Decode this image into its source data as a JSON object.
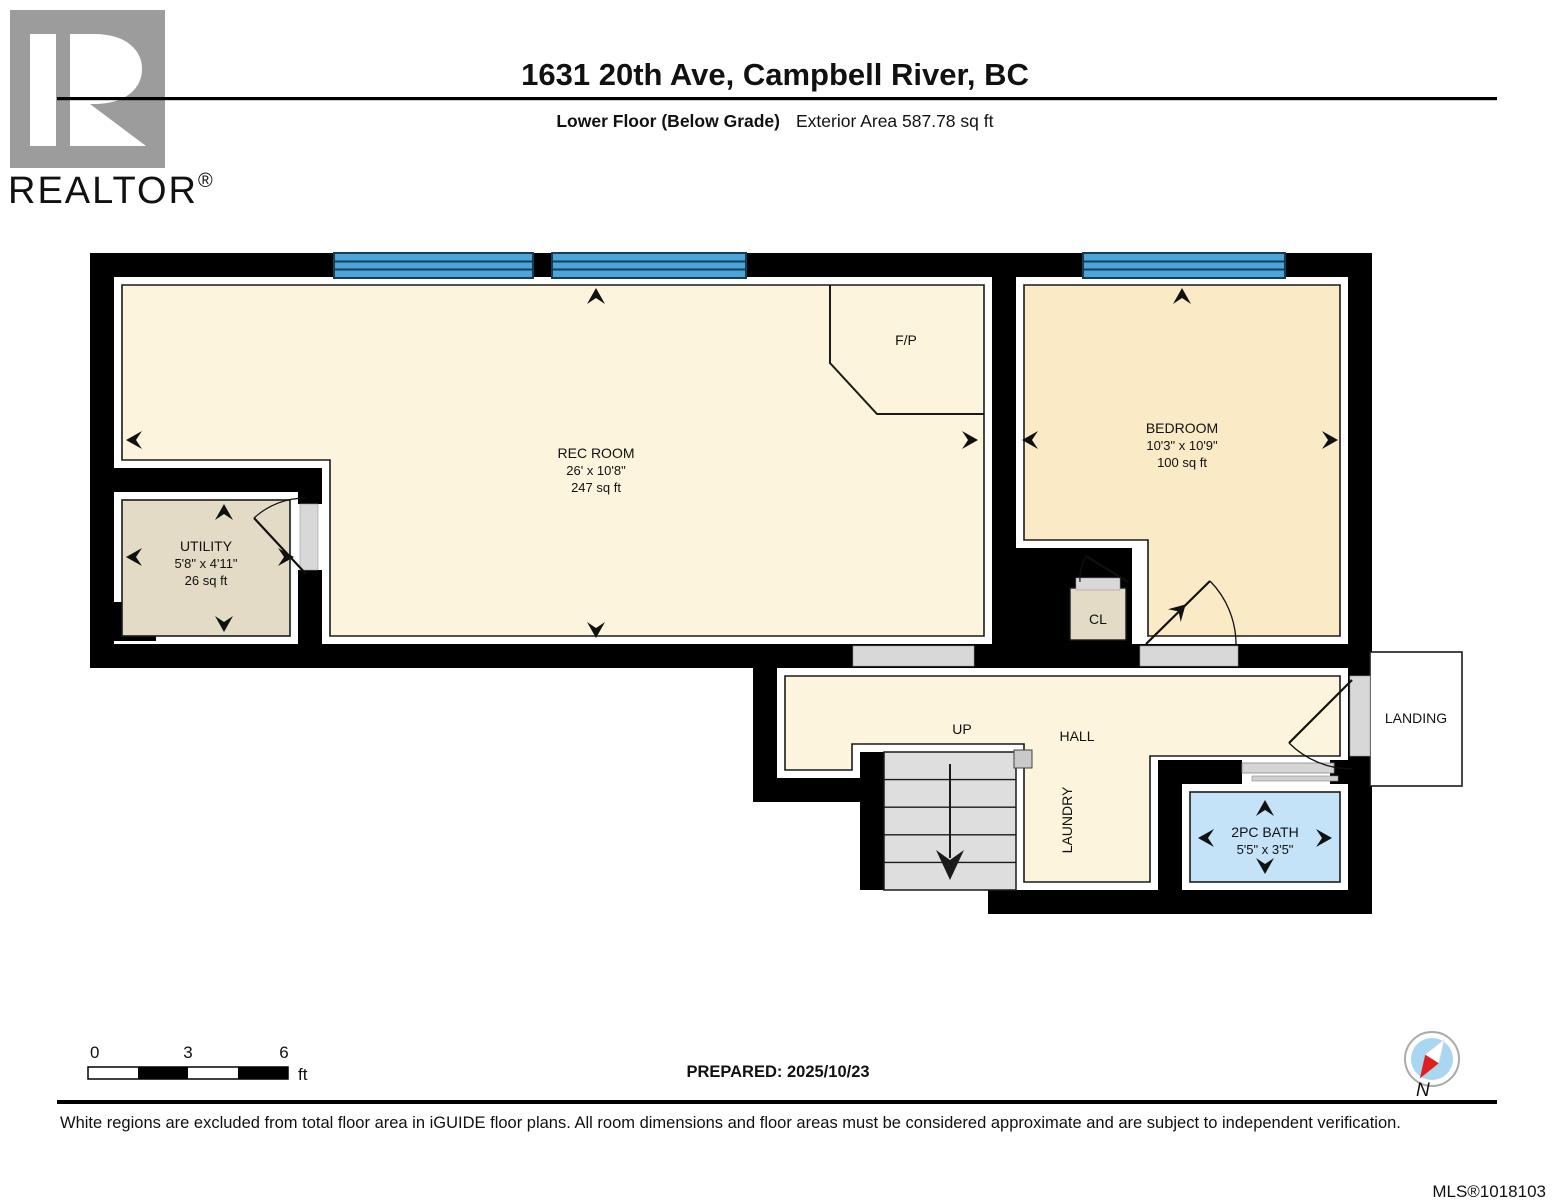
{
  "header": {
    "brand": "REALTOR",
    "brand_reg": "®",
    "title": "1631 20th Ave, Campbell River, BC",
    "floor_label": "Lower Floor (Below Grade)",
    "area_label": "Exterior Area 587.78 sq ft"
  },
  "plan": {
    "rooms": {
      "rec": {
        "name": "REC ROOM",
        "dims": "26' x 10'8\"",
        "area": "247 sq ft"
      },
      "bedroom": {
        "name": "BEDROOM",
        "dims": "10'3\" x 10'9\"",
        "area": "100 sq ft"
      },
      "utility": {
        "name": "UTILITY",
        "dims": "5'8\" x 4'11\"",
        "area": "26 sq ft"
      },
      "bath": {
        "name": "2PC BATH",
        "dims": "5'5\" x 3'5\""
      },
      "fireplace": "F/P",
      "closet": "CL",
      "hall": "HALL",
      "up": "UP",
      "laundry": "LAUNDRY",
      "landing": "LANDING"
    },
    "colors": {
      "wall": "#000000",
      "rec_floor": "#FCF4DC",
      "bedroom_floor": "#FAEBC6",
      "utility_floor": "#E3DBC6",
      "bath_floor": "#C4E3F8",
      "window": "#4DA4D9",
      "stairs": "#DEDEDE",
      "threshold": "#D8D8D8"
    }
  },
  "footer": {
    "scale": {
      "t0": "0",
      "t3": "3",
      "t6": "6",
      "unit": "ft"
    },
    "prepared": "PREPARED: 2025/10/23",
    "compass": "N",
    "disclaimer": "White regions are excluded from total floor area in iGUIDE floor plans. All room dimensions and floor areas must be considered approximate and are subject to independent verification.",
    "mls": "MLS®1018103"
  }
}
